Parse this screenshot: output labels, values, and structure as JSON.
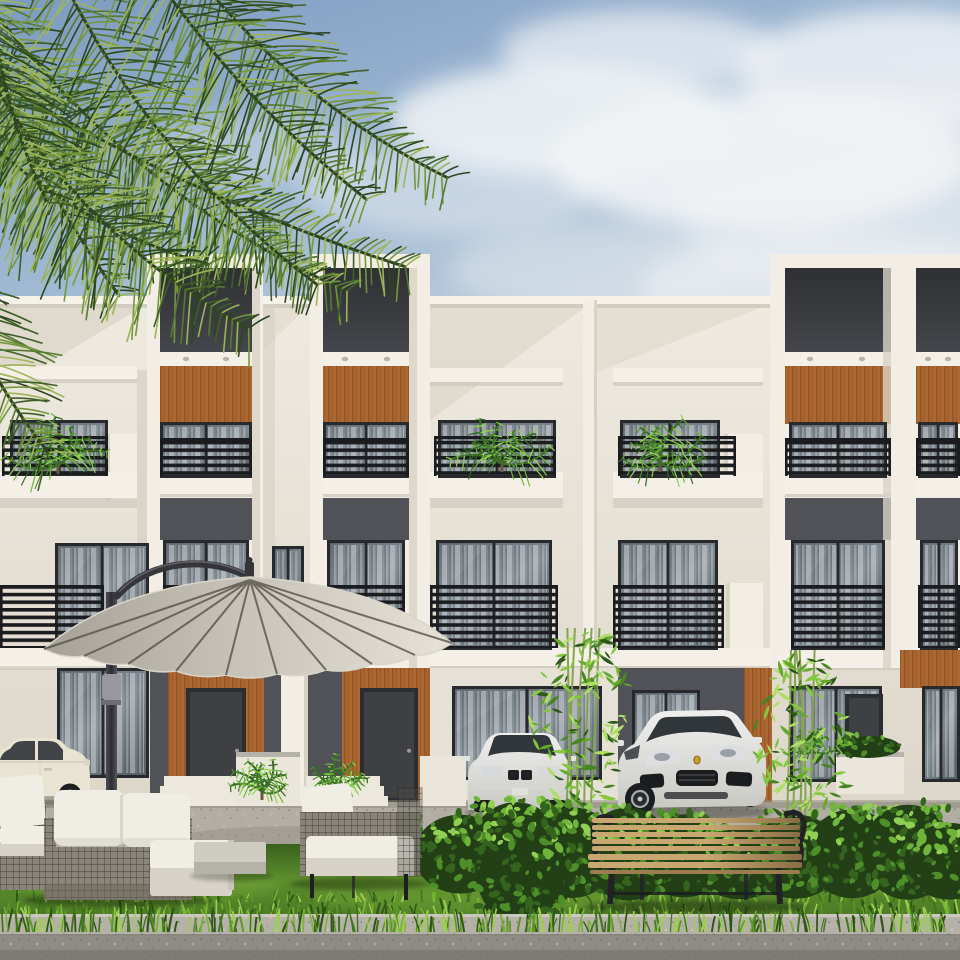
{
  "scene": {
    "title": "Architectural rendering: modern three-storey townhouse complex with landscaped front yard",
    "type": "architectural-exterior-rendering",
    "floors": 3,
    "tower_bays": 4,
    "objects": [
      {
        "name": "sky",
        "label": "Partly cloudy blue sky"
      },
      {
        "name": "palm-fronds",
        "label": "Overhanging palm fronds in top-left corner"
      },
      {
        "name": "building",
        "label": "White modern townhouse block with charcoal recesses and wood panelling"
      },
      {
        "name": "balconies",
        "label": "Balconies with black slat railings and potted palms"
      },
      {
        "name": "entrances",
        "label": "Recessed ground-floor entrances with wood door surrounds"
      },
      {
        "name": "umbrella",
        "label": "Beige cantilever patio umbrella"
      },
      {
        "name": "sofa-set",
        "label": "Wire-frame garden sofa set with white cushions"
      },
      {
        "name": "coffee-table",
        "label": "Concrete garden table"
      },
      {
        "name": "bench",
        "label": "Wooden park bench with black iron arms"
      },
      {
        "name": "hedge",
        "label": "Leafy hedge row"
      },
      {
        "name": "lawn",
        "label": "Front lawn with tall grass tufts"
      },
      {
        "name": "bamboo",
        "label": "Two bamboo shrubs"
      },
      {
        "name": "suv",
        "label": "White luxury SUV parked at entrance"
      },
      {
        "name": "sedan-center",
        "label": "White sedan partly hidden by bamboo"
      },
      {
        "name": "sedan-left",
        "label": "Cream sedan at left edge"
      },
      {
        "name": "road",
        "label": "Speckled kerb and asphalt road in foreground"
      }
    ]
  },
  "palette": {
    "skyTop": "#7d9bc1",
    "skyMid": "#9fb9d3",
    "skyLow": "#ccd7e1",
    "cloud": "#f2f4f6",
    "facadeTop": "#efeae0",
    "facadeBottom": "#ddd7ca",
    "slab": "#f4f0e8",
    "slabShadow": "#c9c3b6",
    "parapet": "#f6f2ea",
    "frameWhite": "#f2eee6",
    "frameSide": "#d8d2c5",
    "recessTop": "#2e3034",
    "recessBottom": "#44464b",
    "charcoal": "#505257",
    "door": "#3e4044",
    "winframe": "#27292c",
    "glassA": "#59636b",
    "glassB": "#7f8991",
    "curtain": "#ded9cf",
    "wood": "#a9642f",
    "woodDark": "#7e4a20",
    "woodLight": "#c07a3d",
    "railing": "#1b1c1f",
    "pavement": "#b2aea5",
    "pavementDark": "#979288",
    "steps": "#ece8de",
    "planter": "#eae6dc",
    "canopyDark": "#a6a196",
    "canopyMid": "#c6c1b6",
    "canopyLight": "#e6e2d7",
    "canopyEdge": "#f1ede3",
    "ribs": "#4e4a43",
    "mast": "#35353a",
    "wicker": "#8b8478",
    "wickerLine": "#33312d",
    "cushion": "#f0ede5",
    "cushionShade": "#d7d3c8",
    "concrete": "#cfccc3",
    "concreteSide": "#b5b2a9",
    "carCream": "#e9e3d1",
    "carWhite": "#eff0ee",
    "carShade": "#c9c9c4",
    "carGlass": "#31363b",
    "wheel": "#1d1e21",
    "rim": "#a8abae",
    "badge": "#c8a02b",
    "benchA": "#c8a771",
    "benchB": "#8a6d45",
    "benchMetal": "#222225",
    "lawnDark": "#3f6a22",
    "lawnMid": "#5c8c2c",
    "lawnLight": "#7fb23c",
    "curb": "#b5b1a8",
    "road": "#8f8c85",
    "roadDark": "#797671",
    "palmCorner": [
      "#2c461f",
      "#3f5e29",
      "#567a31",
      "#74973e",
      "#9db457"
    ],
    "palmBright": [
      "#2f6a20",
      "#4c9429",
      "#6cb838",
      "#8fd44c"
    ],
    "bamboo": [
      "#2e5a18",
      "#478423",
      "#64a82e",
      "#86c741",
      "#aede62"
    ],
    "hedge": [
      "#223f16",
      "#35641f",
      "#4f8f2a",
      "#6fb53a",
      "#92d054"
    ],
    "grass": [
      "#2d5316",
      "#40741d",
      "#5c9627",
      "#79b335",
      "#9ccf4f"
    ]
  }
}
